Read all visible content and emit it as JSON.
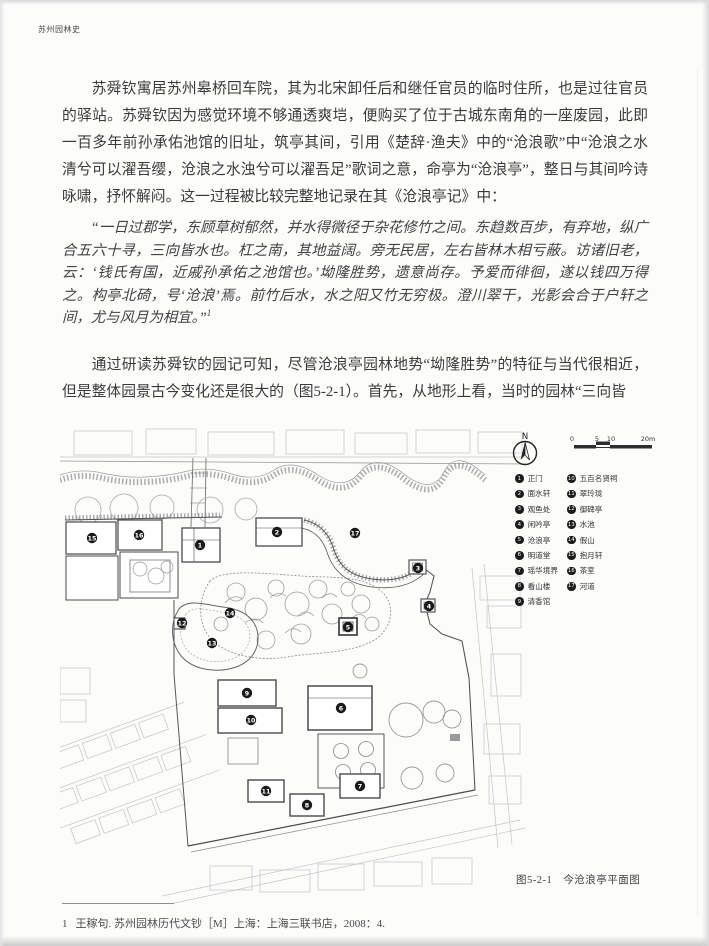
{
  "page": {
    "running_header": "苏州园林史",
    "paragraphs": {
      "p1": "苏舜钦寓居苏州皋桥回车院，其为北宋卸任后和继任官员的临时住所，也是过往官员的驿站。苏舜钦因为感觉环境不够通透爽垲，便购买了位于古城东南角的一座废园，此即一百多年前孙承佑池馆的旧址，筑亭其间，引用《楚辞·渔夫》中的“沧浪歌”中“沧浪之水清兮可以濯吾缨，沧浪之水浊兮可以濯吾足”歌词之意，命亭为“沧浪亭”，整日与其间吟诗咏啸，抒怀解闷。这一过程被比较完整地记录在其《沧浪亭记》中：",
      "quote": "“一日过郡学，东顾草树郁然，并水得微径于杂花修竹之间。东趋数百步，有弃地，纵广合五六十寻，三向皆水也。杠之南，其地益阔。旁无民居，左右皆林木相亏蔽。访诸旧老，云：‘钱氏有国，近戚孙承佑之池馆也。’坳隆胜势，遗意尚存。予爱而徘徊，遂以钱四万得之。构亭北碕，号‘沧浪’焉。前竹后水，水之阳又竹无穷极。澄川翠干，光影会合于户轩之间，尤与风月为相宜。”",
      "quote_ref": "1",
      "p3": "通过研读苏舜钦的园记可知，尽管沧浪亭园林地势“坳隆胜势”的特征与当代很相近，但是整体园景古今变化还是很大的（图5-2-1）。首先，从地形上看，当时的园林“三向皆"
    },
    "footnote": {
      "number": "1",
      "text": "王稼句. 苏州园林历代文钞［M］上海：上海三联书店，2008：4."
    }
  },
  "figure": {
    "caption": "图5-2-1　今沧浪亭平面图",
    "north_label": "N",
    "scale": {
      "t0": "0",
      "t1": "5",
      "t2": "10",
      "t3": "20m"
    },
    "legend": {
      "items": [
        {
          "num": "1",
          "label": "正门"
        },
        {
          "num": "2",
          "label": "面水轩"
        },
        {
          "num": "3",
          "label": "观鱼处"
        },
        {
          "num": "4",
          "label": "闲吟亭"
        },
        {
          "num": "5",
          "label": "沧浪亭"
        },
        {
          "num": "6",
          "label": "明道堂"
        },
        {
          "num": "7",
          "label": "瑶华境界"
        },
        {
          "num": "8",
          "label": "看山楼"
        },
        {
          "num": "9",
          "label": "清香馆"
        },
        {
          "num": "10",
          "label": "五百名贤祠"
        },
        {
          "num": "11",
          "label": "翠玲珑"
        },
        {
          "num": "12",
          "label": "御碑亭"
        },
        {
          "num": "13",
          "label": "水池"
        },
        {
          "num": "14",
          "label": "假山"
        },
        {
          "num": "15",
          "label": "抱月轩"
        },
        {
          "num": "16",
          "label": "茶室"
        },
        {
          "num": "17",
          "label": "河道"
        }
      ]
    },
    "map": {
      "markers": [
        {
          "num": "1",
          "x": 140,
          "y": 117
        },
        {
          "num": "2",
          "x": 217,
          "y": 104
        },
        {
          "num": "3",
          "x": 358,
          "y": 140
        },
        {
          "num": "4",
          "x": 369,
          "y": 178
        },
        {
          "num": "5",
          "x": 288,
          "y": 199
        },
        {
          "num": "6",
          "x": 281,
          "y": 280
        },
        {
          "num": "7",
          "x": 300,
          "y": 358
        },
        {
          "num": "8",
          "x": 247,
          "y": 377
        },
        {
          "num": "9",
          "x": 187,
          "y": 265
        },
        {
          "num": "10",
          "x": 191,
          "y": 292
        },
        {
          "num": "11",
          "x": 206,
          "y": 363
        },
        {
          "num": "12",
          "x": 122,
          "y": 195
        },
        {
          "num": "13",
          "x": 152,
          "y": 215
        },
        {
          "num": "14",
          "x": 170,
          "y": 185
        },
        {
          "num": "15",
          "x": 32,
          "y": 110
        },
        {
          "num": "16",
          "x": 79,
          "y": 107
        },
        {
          "num": "17",
          "x": 295,
          "y": 105
        }
      ]
    }
  }
}
